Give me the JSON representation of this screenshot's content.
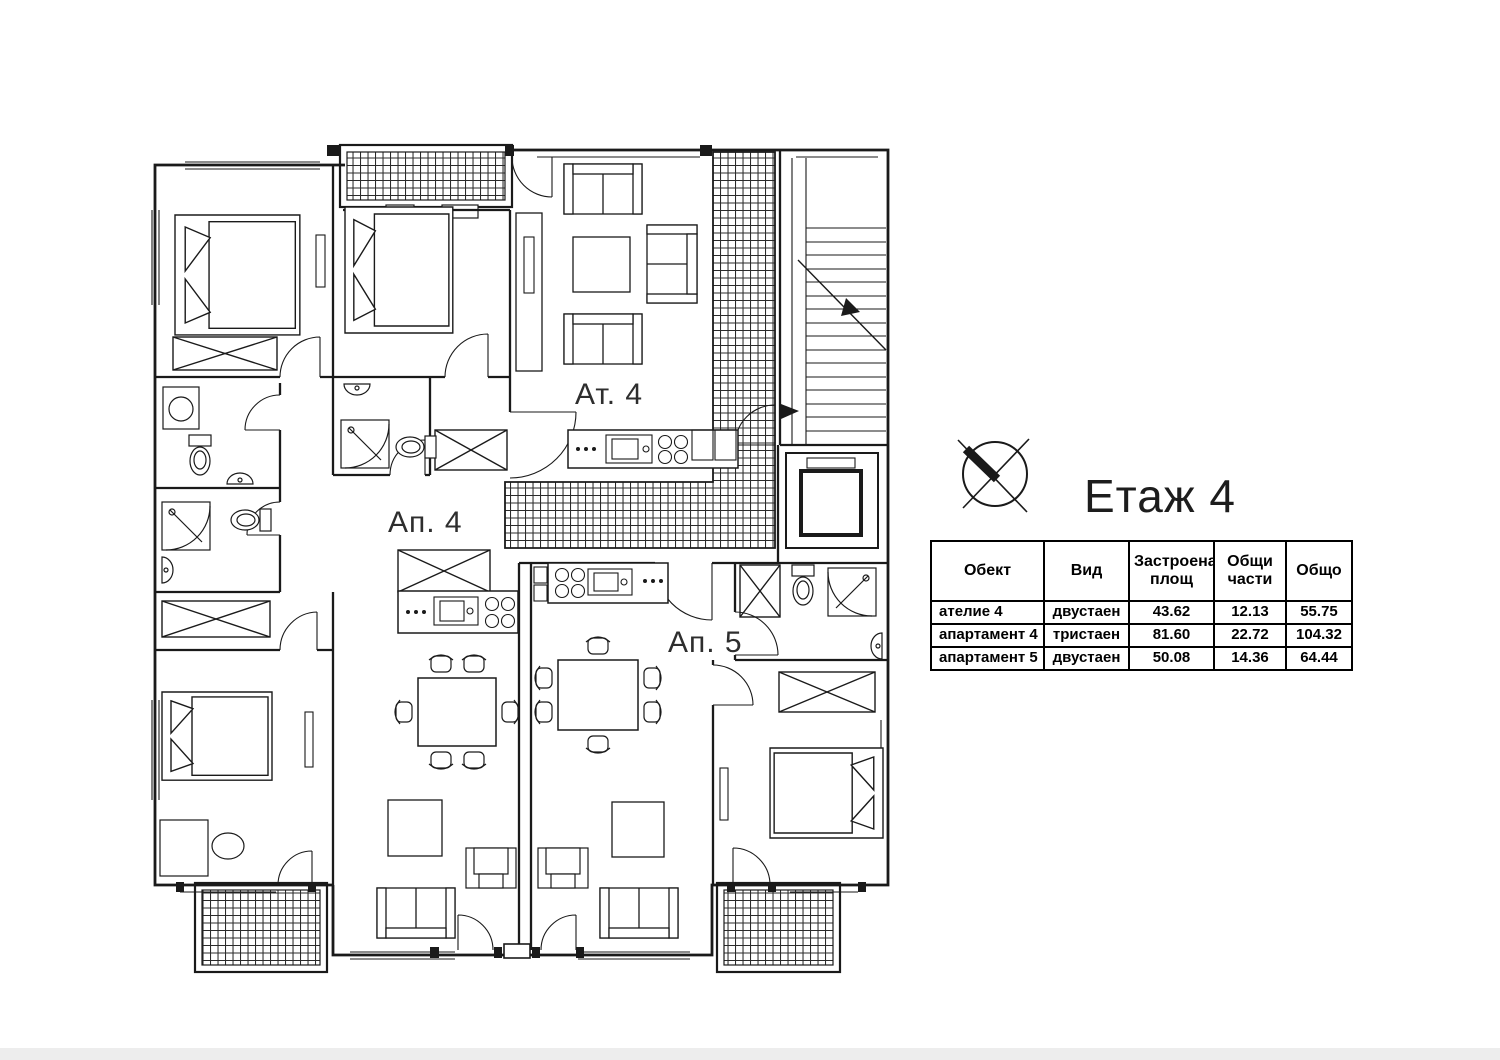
{
  "page": {
    "background_color": "#ffffff",
    "line_color": "#1a1a1a"
  },
  "floor_plan": {
    "unit_labels": [
      {
        "id": "atelier-4",
        "label": "Ат. 4"
      },
      {
        "id": "apartment-4",
        "label": "Ап. 4"
      },
      {
        "id": "apartment-5",
        "label": "Ап. 5"
      }
    ],
    "icons": [
      {
        "name": "north-arrow-icon"
      }
    ]
  },
  "header": {
    "title": "Етаж 4"
  },
  "area_table": {
    "columns": [
      "Обект",
      "Вид",
      "Застроена площ",
      "Общи части",
      "Общо"
    ],
    "rows": [
      [
        "ателие 4",
        "двустаен",
        "43.62",
        "12.13",
        "55.75"
      ],
      [
        "апартамент 4",
        "тристаен",
        "81.60",
        "22.72",
        "104.32"
      ],
      [
        "апартамент 5",
        "двустаен",
        "50.08",
        "14.36",
        "64.44"
      ]
    ]
  }
}
